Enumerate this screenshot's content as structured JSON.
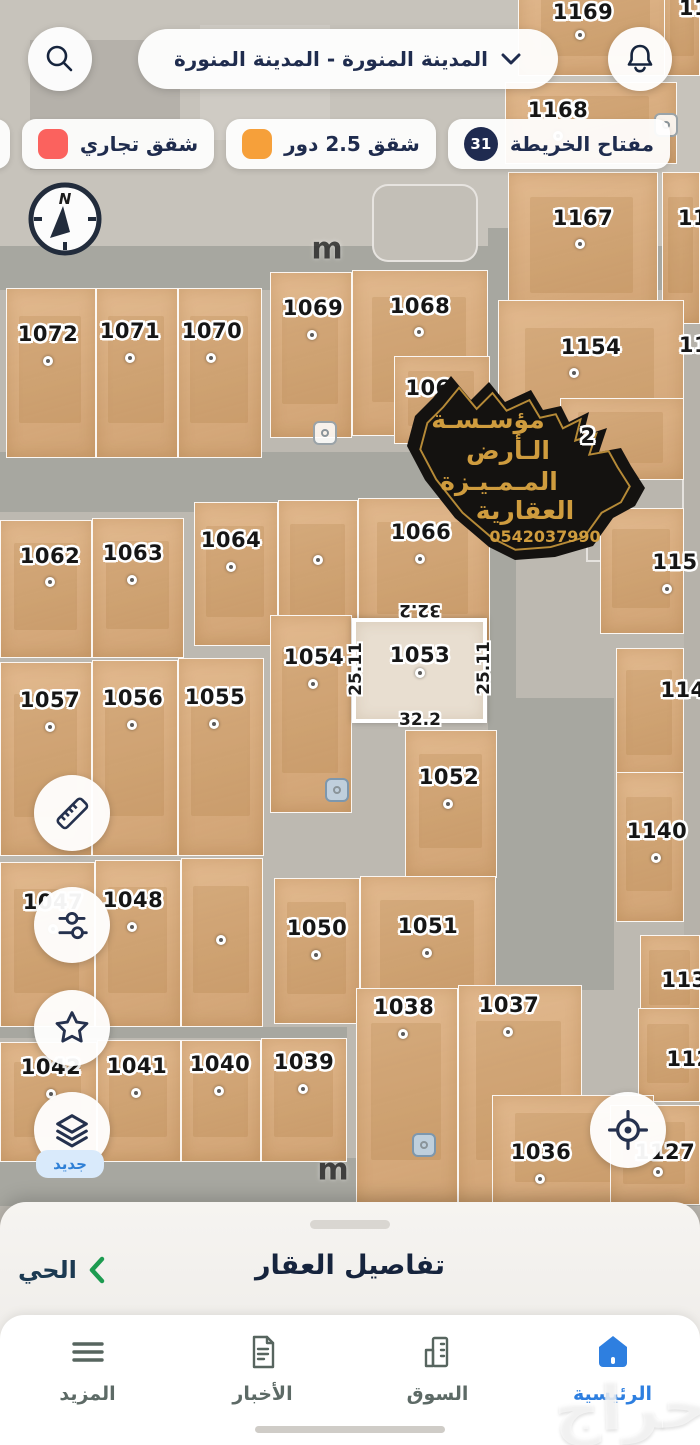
{
  "app": {
    "city_selector": "المدينة المنورة - المدينة المنورة"
  },
  "legend": {
    "map_key": {
      "label": "مفتاح الخريطة",
      "count": "31"
    },
    "items": [
      {
        "label": "شقق 2.5 دور",
        "color": "#f6a03a"
      },
      {
        "label": "شقق تجاري",
        "color": "#fb625e"
      }
    ],
    "partial_color": "#fb625e"
  },
  "compass": {
    "north": "N"
  },
  "watermark": {
    "line1": "مؤسـسـة",
    "line2": "الـأرض",
    "line3": "المـمـيـزة",
    "line4": "العقارية",
    "phone": "0542037990"
  },
  "map": {
    "road_labels": [
      {
        "text": "m",
        "x": 327,
        "y": 249
      },
      {
        "text": "m",
        "x": 333,
        "y": 1170
      }
    ],
    "markers": [
      {
        "x": 666,
        "y": 125,
        "tint": "light"
      },
      {
        "x": 325,
        "y": 433,
        "tint": "light"
      },
      {
        "x": 337,
        "y": 790,
        "tint": "blue"
      },
      {
        "x": 424,
        "y": 1145,
        "tint": "blue"
      }
    ],
    "selected": {
      "id": "1053",
      "top": "32.2",
      "bottom": "32.2",
      "left": "25.11",
      "right": "25.11"
    },
    "parcels": [
      {
        "id": "1169",
        "rect": [
          518,
          -20,
          158,
          96
        ],
        "label": [
          583,
          12
        ],
        "dot": [
          580,
          35
        ]
      },
      {
        "id": "11",
        "rect": [
          664,
          -20,
          36,
          96
        ],
        "label": [
          694,
          8
        ],
        "dot": null,
        "partial": true
      },
      {
        "id": "1168",
        "rect": [
          505,
          82,
          172,
          82
        ],
        "label": [
          558,
          110
        ],
        "dot": [
          558,
          136
        ]
      },
      {
        "id": "1167",
        "rect": [
          508,
          172,
          150,
          152
        ],
        "label": [
          583,
          218
        ],
        "dot": [
          580,
          244
        ]
      },
      {
        "id": "11",
        "rect": [
          662,
          172,
          38,
          152
        ],
        "label": [
          693,
          218
        ],
        "dot": null,
        "partial": true
      },
      {
        "id": "1154",
        "rect": [
          498,
          300,
          186,
          172
        ],
        "label": [
          591,
          347
        ],
        "dot": [
          574,
          373
        ]
      },
      {
        "id": "11",
        "rect": null,
        "label": [
          694,
          345
        ],
        "dot": null,
        "partial": true
      },
      {
        "id": "1072",
        "rect": [
          6,
          288,
          90,
          170
        ],
        "label": [
          48,
          334
        ],
        "dot": [
          48,
          361
        ]
      },
      {
        "id": "1071",
        "rect": [
          96,
          288,
          82,
          170
        ],
        "label": [
          130,
          331
        ],
        "dot": [
          130,
          358
        ]
      },
      {
        "id": "1070",
        "rect": [
          178,
          288,
          84,
          170
        ],
        "label": [
          212,
          331
        ],
        "dot": [
          211,
          358
        ]
      },
      {
        "id": "1069",
        "rect": [
          270,
          272,
          82,
          166
        ],
        "label": [
          313,
          308
        ],
        "dot": [
          312,
          335
        ]
      },
      {
        "id": "1068",
        "rect": [
          352,
          270,
          136,
          166
        ],
        "label": [
          420,
          306
        ],
        "dot": [
          419,
          332
        ]
      },
      {
        "id": "106",
        "rect": [
          394,
          356,
          96,
          88
        ],
        "label": [
          428,
          388
        ],
        "dot": null,
        "partial": true
      },
      {
        "id": "2",
        "rect": [
          560,
          398,
          124,
          82
        ],
        "label": [
          588,
          436
        ],
        "dot": [
          573,
          508
        ],
        "above": true
      },
      {
        "id": "1062",
        "rect": [
          0,
          520,
          92,
          138
        ],
        "label": [
          50,
          556
        ],
        "dot": [
          50,
          582
        ]
      },
      {
        "id": "1063",
        "rect": [
          92,
          518,
          92,
          140
        ],
        "label": [
          133,
          553
        ],
        "dot": [
          132,
          580
        ]
      },
      {
        "id": "1064",
        "rect": [
          194,
          502,
          84,
          144
        ],
        "label": [
          231,
          540
        ],
        "dot": [
          231,
          567
        ]
      },
      {
        "id": "",
        "rect": [
          278,
          500,
          80,
          146
        ],
        "label": null,
        "dot": [
          318,
          560
        ]
      },
      {
        "id": "1066",
        "rect": [
          358,
          498,
          132,
          146
        ],
        "label": [
          421,
          532
        ],
        "dot": [
          420,
          559
        ]
      },
      {
        "id": "115",
        "rect": [
          600,
          508,
          84,
          126
        ],
        "label": [
          675,
          562
        ],
        "dot": [
          667,
          589
        ],
        "partial": true
      },
      {
        "id": "1057",
        "rect": [
          0,
          662,
          92,
          194
        ],
        "label": [
          50,
          700
        ],
        "dot": [
          50,
          727
        ]
      },
      {
        "id": "1056",
        "rect": [
          92,
          660,
          86,
          196
        ],
        "label": [
          133,
          698
        ],
        "dot": [
          132,
          725
        ]
      },
      {
        "id": "1055",
        "rect": [
          178,
          658,
          86,
          198
        ],
        "label": [
          215,
          697
        ],
        "dot": [
          214,
          724
        ]
      },
      {
        "id": "1054",
        "rect": [
          270,
          615,
          82,
          198
        ],
        "label": [
          314,
          657
        ],
        "dot": [
          313,
          684
        ]
      },
      {
        "id": "114",
        "rect": [
          616,
          648,
          68,
          134
        ],
        "label": [
          683,
          690
        ],
        "dot": null,
        "partial": true
      },
      {
        "id": "1052",
        "rect": [
          405,
          730,
          92,
          148
        ],
        "label": [
          449,
          777
        ],
        "dot": [
          448,
          804
        ]
      },
      {
        "id": "1140",
        "rect": [
          616,
          772,
          68,
          150
        ],
        "label": [
          657,
          831
        ],
        "dot": [
          656,
          858
        ]
      },
      {
        "id": "1047",
        "rect": [
          0,
          862,
          95,
          165
        ],
        "label": [
          53,
          902
        ],
        "dot": [
          53,
          929
        ]
      },
      {
        "id": "1048",
        "rect": [
          95,
          860,
          86,
          167
        ],
        "label": [
          133,
          900
        ],
        "dot": [
          132,
          927
        ]
      },
      {
        "id": "",
        "rect": [
          181,
          858,
          82,
          169
        ],
        "label": null,
        "dot": [
          221,
          940
        ]
      },
      {
        "id": "1050",
        "rect": [
          274,
          878,
          86,
          146
        ],
        "label": [
          317,
          928
        ],
        "dot": [
          316,
          955
        ]
      },
      {
        "id": "1051",
        "rect": [
          360,
          876,
          136,
          148
        ],
        "label": [
          428,
          926
        ],
        "dot": [
          427,
          953
        ]
      },
      {
        "id": "113",
        "rect": [
          640,
          935,
          60,
          88
        ],
        "label": [
          684,
          980
        ],
        "dot": null,
        "partial": true
      },
      {
        "id": "1038",
        "rect": [
          356,
          988,
          102,
          216
        ],
        "label": [
          404,
          1007
        ],
        "dot": [
          403,
          1034
        ]
      },
      {
        "id": "1037",
        "rect": [
          458,
          985,
          124,
          219
        ],
        "label": [
          509,
          1005
        ],
        "dot": [
          508,
          1032
        ]
      },
      {
        "id": "112",
        "rect": [
          638,
          1008,
          62,
          94
        ],
        "label": [
          689,
          1059
        ],
        "dot": null,
        "partial": true
      },
      {
        "id": "1042",
        "rect": [
          0,
          1042,
          97,
          120
        ],
        "label": [
          51,
          1067
        ],
        "dot": [
          51,
          1094
        ]
      },
      {
        "id": "1041",
        "rect": [
          97,
          1040,
          84,
          122
        ],
        "label": [
          137,
          1066
        ],
        "dot": [
          136,
          1093
        ]
      },
      {
        "id": "1040",
        "rect": [
          181,
          1040,
          80,
          122
        ],
        "label": [
          220,
          1064
        ],
        "dot": [
          219,
          1091
        ]
      },
      {
        "id": "1039",
        "rect": [
          261,
          1038,
          86,
          124
        ],
        "label": [
          304,
          1062
        ],
        "dot": [
          303,
          1089
        ]
      },
      {
        "id": "1036",
        "rect": [
          492,
          1095,
          162,
          110
        ],
        "label": [
          541,
          1152
        ],
        "dot": [
          540,
          1179
        ]
      },
      {
        "id": "1127",
        "rect": [
          610,
          1105,
          90,
          100
        ],
        "label": [
          665,
          1152
        ],
        "dot": [
          658,
          1172
        ]
      },
      {
        "id": "1053",
        "rect": [
          352,
          618,
          135,
          105
        ],
        "label": [
          420,
          655
        ],
        "dot": [
          420,
          673
        ],
        "selected": true
      }
    ]
  },
  "new_badge": "جديد",
  "sheet": {
    "title": "تفاصيل العقار",
    "district": "الحي"
  },
  "navbar": {
    "items": [
      {
        "label": "الرئيسية",
        "icon": "home-icon",
        "active": true
      },
      {
        "label": "السوق",
        "icon": "market-icon",
        "active": false
      },
      {
        "label": "الأخبار",
        "icon": "news-icon",
        "active": false
      },
      {
        "label": "المزيد",
        "icon": "more-icon",
        "active": false
      }
    ]
  },
  "brand_watermark": "حراج",
  "colors": {
    "accent_blue": "#2e7fe0",
    "navy": "#1f2b50",
    "green": "#1d9b50",
    "parcel_tan": "#ddad7b",
    "selected_fill": "#e8ded0",
    "orange": "#f6a03a",
    "red": "#fb625e"
  }
}
